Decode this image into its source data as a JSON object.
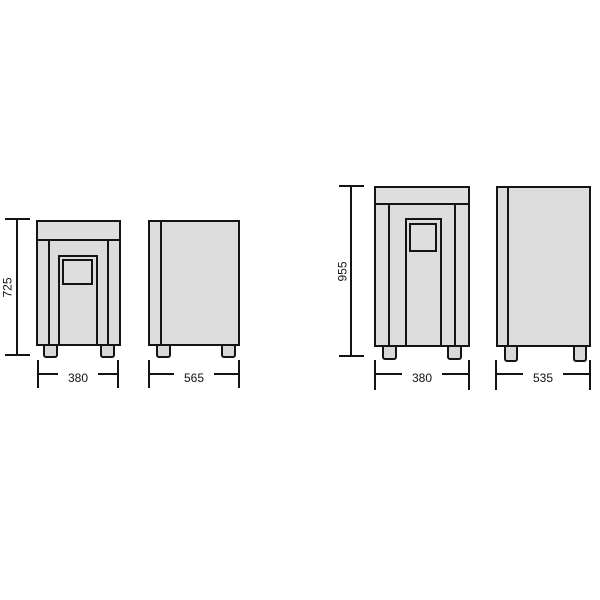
{
  "colors": {
    "background": "#ffffff",
    "cabinet_fill": "#dcdcdc",
    "line": "#141414",
    "label_text": "#111111"
  },
  "units": [
    {
      "id": "small-unit",
      "height_label": "725",
      "front_width_label": "380",
      "side_depth_label": "565"
    },
    {
      "id": "large-unit",
      "height_label": "955",
      "front_width_label": "380",
      "side_depth_label": "535"
    }
  ]
}
